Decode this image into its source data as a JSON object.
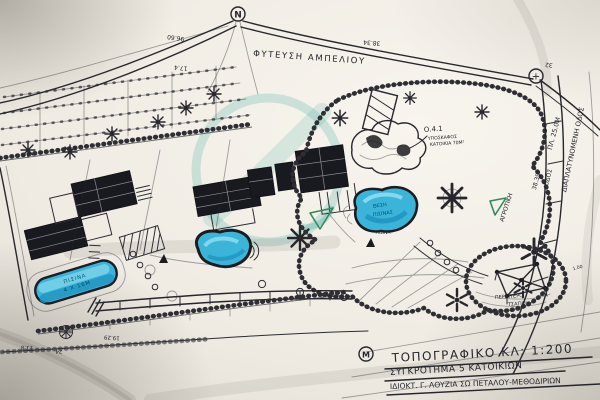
{
  "colors": {
    "paper": "#efebe3",
    "ink": "#26262c",
    "pool_blue": "#3ab5d9",
    "pool_deep": "#1f93be",
    "watermark_teal": "#209e94",
    "pen_green": "#2f8b5a"
  },
  "plan": {
    "north_marker": "N",
    "boundary_marker": "+",
    "title_marker": "M",
    "planting_label": "ΦΥΤΕΥΣΗ ΑΜΠΕΛΙΟΥ",
    "underground": {
      "ref": "Ο.4.1",
      "line1": "ΥΠΟΣΚΑΦΟΣ",
      "line2": "ΚΑΤΟΙΚΙΑ 70Μ²"
    },
    "pool_left": {
      "line1": "ΠΙΣΙΝΑ",
      "line2": "4 Χ 16Μ"
    },
    "pool_right": {
      "line1": "ΘΕΣΗ",
      "line2": "ΠΙΣΙΝΑΣ",
      "caption": "ΠΙΣΙΝΑ"
    },
    "pergola": {
      "line1": "ΠΕΡΙΠΤΕΡΟ",
      "line2": "ΤΣΑΓΙΟΥ"
    },
    "roads": {
      "widened": "ΔΙΑΠΛΑΤΥΝΟΜΕΝΗ ΟΔΟΣ",
      "width": "ΠΛ. 25.0Μ",
      "number": "38.39",
      "word": "ΟΔΟΣ",
      "rural": "ΑΓΡΟΤΙΚΗ"
    },
    "dimensions": {
      "top": "96.60",
      "top2": "17.4",
      "top_right": "38.34",
      "right": "32",
      "bottom1": "11.8",
      "bottom2": "24",
      "bottom3": "19.29",
      "terrace": "1.00"
    }
  },
  "title_block": {
    "line1": "ΤΟΠΟΓΡΑΦΙΚΟ ΚΛ: 1:200",
    "line2": "ΣΥΓΚΡΟΤΗΜΑ 5 ΚΑΤΟΙΚΙΩΝ",
    "line3": "ΙΔΙΟΚΤ. Γ. ΛΟΥΖΙΑ ΣΩ ΠΕΤΑΛΟΥ-ΜΕΘΟΔΙΡΙΩΝ"
  }
}
